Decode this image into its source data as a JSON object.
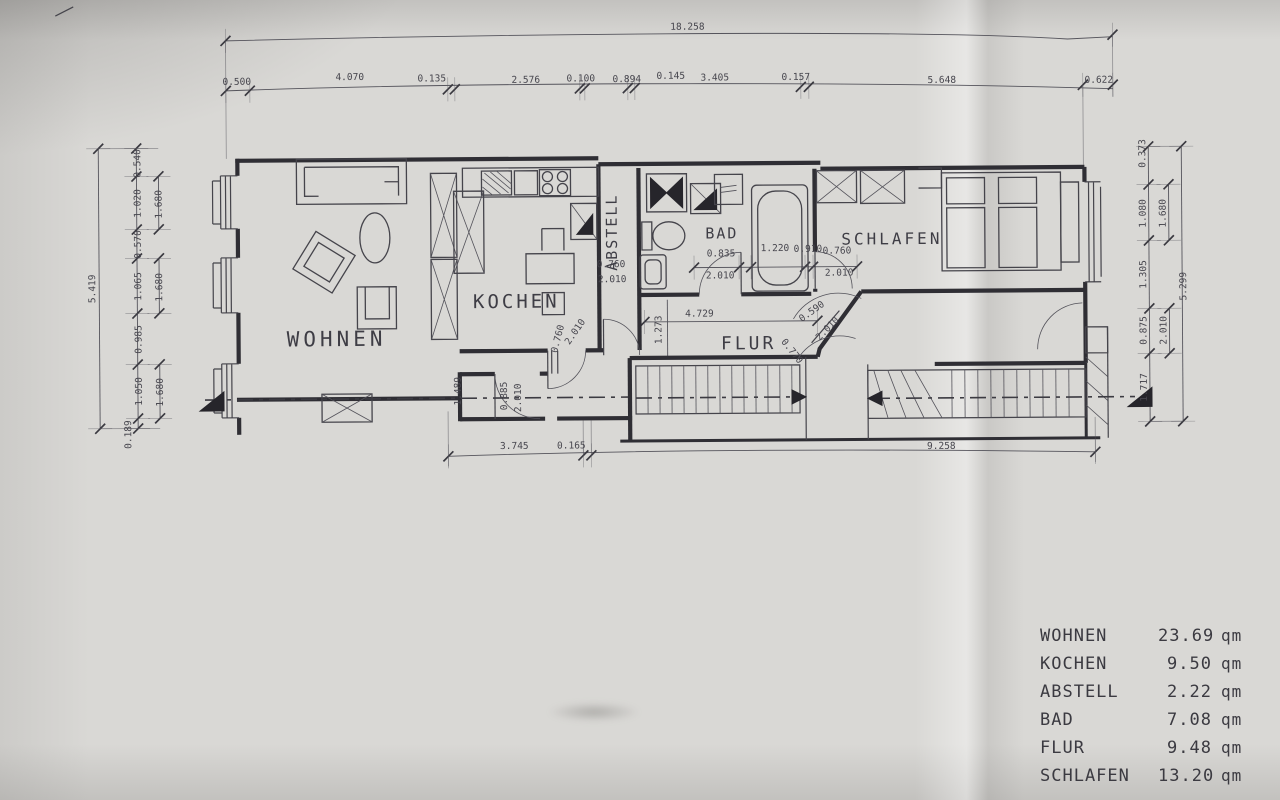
{
  "colors": {
    "paper": "#d9d8d5",
    "ink": "#2f2e34",
    "dim_ink": "#47464e"
  },
  "area_table": {
    "rows": [
      {
        "name": "WOHNEN",
        "value": "23.69",
        "unit": "qm"
      },
      {
        "name": "KOCHEN",
        "value": "9.50",
        "unit": "qm"
      },
      {
        "name": "ABSTELL",
        "value": "2.22",
        "unit": "qm"
      },
      {
        "name": "BAD",
        "value": "7.08",
        "unit": "qm"
      },
      {
        "name": "FLUR",
        "value": "9.48",
        "unit": "qm"
      },
      {
        "name": "SCHLAFEN",
        "value": "13.20",
        "unit": "qm"
      }
    ]
  },
  "room_labels": [
    {
      "t": "WOHNEN",
      "x": 337,
      "y": 344,
      "r": 0,
      "s": 21,
      "ls": 4
    },
    {
      "t": "KOCHEN",
      "x": 517,
      "y": 307,
      "r": 0,
      "s": 19,
      "ls": 3
    },
    {
      "t": "ABSTELL",
      "x": 618,
      "y": 232,
      "r": -90,
      "s": 15,
      "ls": 2
    },
    {
      "t": "BAD",
      "x": 723,
      "y": 239,
      "r": 0,
      "s": 15,
      "ls": 2
    },
    {
      "t": "FLUR",
      "x": 749,
      "y": 350,
      "r": 0,
      "s": 18,
      "ls": 3
    },
    {
      "t": "SCHLAFEN",
      "x": 893,
      "y": 246,
      "r": 0,
      "s": 16,
      "ls": 3
    }
  ],
  "dim_labels": [
    {
      "t": "18.258",
      "x": 690,
      "y": 30,
      "r": 0
    },
    {
      "t": "0.500",
      "x": 239,
      "y": 82,
      "r": 0
    },
    {
      "t": "4.070",
      "x": 352,
      "y": 78,
      "r": 0
    },
    {
      "t": "0.135",
      "x": 434,
      "y": 80,
      "r": 0
    },
    {
      "t": "2.576",
      "x": 528,
      "y": 82,
      "r": 0
    },
    {
      "t": "0.100",
      "x": 583,
      "y": 81,
      "r": 0
    },
    {
      "t": "0.894",
      "x": 629,
      "y": 82,
      "r": 0
    },
    {
      "t": "0.145",
      "x": 673,
      "y": 79,
      "r": 0
    },
    {
      "t": "3.405",
      "x": 717,
      "y": 81,
      "r": 0
    },
    {
      "t": "0.157",
      "x": 798,
      "y": 81,
      "r": 0
    },
    {
      "t": "5.648",
      "x": 944,
      "y": 85,
      "r": 0
    },
    {
      "t": "0.622",
      "x": 1101,
      "y": 86,
      "r": 0
    },
    {
      "t": "5.419",
      "x": 96,
      "y": 285,
      "r": -90
    },
    {
      "t": "0.540",
      "x": 142,
      "y": 160,
      "r": -90
    },
    {
      "t": "1.020",
      "x": 142,
      "y": 200,
      "r": -90
    },
    {
      "t": "0.570",
      "x": 142,
      "y": 241,
      "r": -90
    },
    {
      "t": "1.065",
      "x": 142,
      "y": 283,
      "r": -90
    },
    {
      "t": "0.985",
      "x": 142,
      "y": 336,
      "r": -90
    },
    {
      "t": "1.050",
      "x": 142,
      "y": 388,
      "r": -90
    },
    {
      "t": "0.189",
      "x": 131,
      "y": 431,
      "r": -90
    },
    {
      "t": "1.680",
      "x": 163,
      "y": 201,
      "r": -90
    },
    {
      "t": "1.680",
      "x": 163,
      "y": 284,
      "r": -90
    },
    {
      "t": "1.680",
      "x": 163,
      "y": 389,
      "r": -90
    },
    {
      "t": "0.373",
      "x": 1147,
      "y": 157,
      "r": -90
    },
    {
      "t": "1.080",
      "x": 1147,
      "y": 217,
      "r": -90
    },
    {
      "t": "1.305",
      "x": 1147,
      "y": 278,
      "r": -90
    },
    {
      "t": "0.875",
      "x": 1147,
      "y": 334,
      "r": -90
    },
    {
      "t": "1.717",
      "x": 1147,
      "y": 391,
      "r": -90
    },
    {
      "t": "1.680",
      "x": 1167,
      "y": 217,
      "r": -90
    },
    {
      "t": "2.010",
      "x": 1167,
      "y": 334,
      "r": -90
    },
    {
      "t": "5.299",
      "x": 1187,
      "y": 290,
      "r": -90
    },
    {
      "t": "3.745",
      "x": 514,
      "y": 448,
      "r": 0
    },
    {
      "t": "0.165",
      "x": 571,
      "y": 448,
      "r": 0
    },
    {
      "t": "9.258",
      "x": 941,
      "y": 451,
      "r": 0
    },
    {
      "t": "0.835",
      "x": 722,
      "y": 257,
      "r": 0
    },
    {
      "t": "2.010",
      "x": 721,
      "y": 279,
      "r": 0
    },
    {
      "t": "1.220",
      "x": 776,
      "y": 252,
      "r": 0
    },
    {
      "t": "0.910",
      "x": 809,
      "y": 253,
      "r": 0
    },
    {
      "t": "0.760",
      "x": 838,
      "y": 255,
      "r": 0
    },
    {
      "t": "2.010",
      "x": 840,
      "y": 277,
      "r": 0
    },
    {
      "t": "0.760",
      "x": 612,
      "y": 267,
      "r": 0
    },
    {
      "t": "2.010",
      "x": 613,
      "y": 282,
      "r": 0
    },
    {
      "t": "4.729",
      "x": 700,
      "y": 317,
      "r": 0
    },
    {
      "t": "1.273",
      "x": 662,
      "y": 330,
      "r": -90
    },
    {
      "t": "0.760",
      "x": 561,
      "y": 339,
      "r": -75
    },
    {
      "t": "2.010",
      "x": 578,
      "y": 333,
      "r": -55
    },
    {
      "t": "1.489",
      "x": 461,
      "y": 390,
      "r": -90
    },
    {
      "t": "0.885",
      "x": 507,
      "y": 395,
      "r": -90
    },
    {
      "t": "2.010",
      "x": 521,
      "y": 397,
      "r": -90
    },
    {
      "t": "0.590",
      "x": 814,
      "y": 315,
      "r": -35
    },
    {
      "t": "2.010",
      "x": 830,
      "y": 332,
      "r": -45
    },
    {
      "t": "0.770",
      "x": 790,
      "y": 354,
      "r": 52
    }
  ]
}
